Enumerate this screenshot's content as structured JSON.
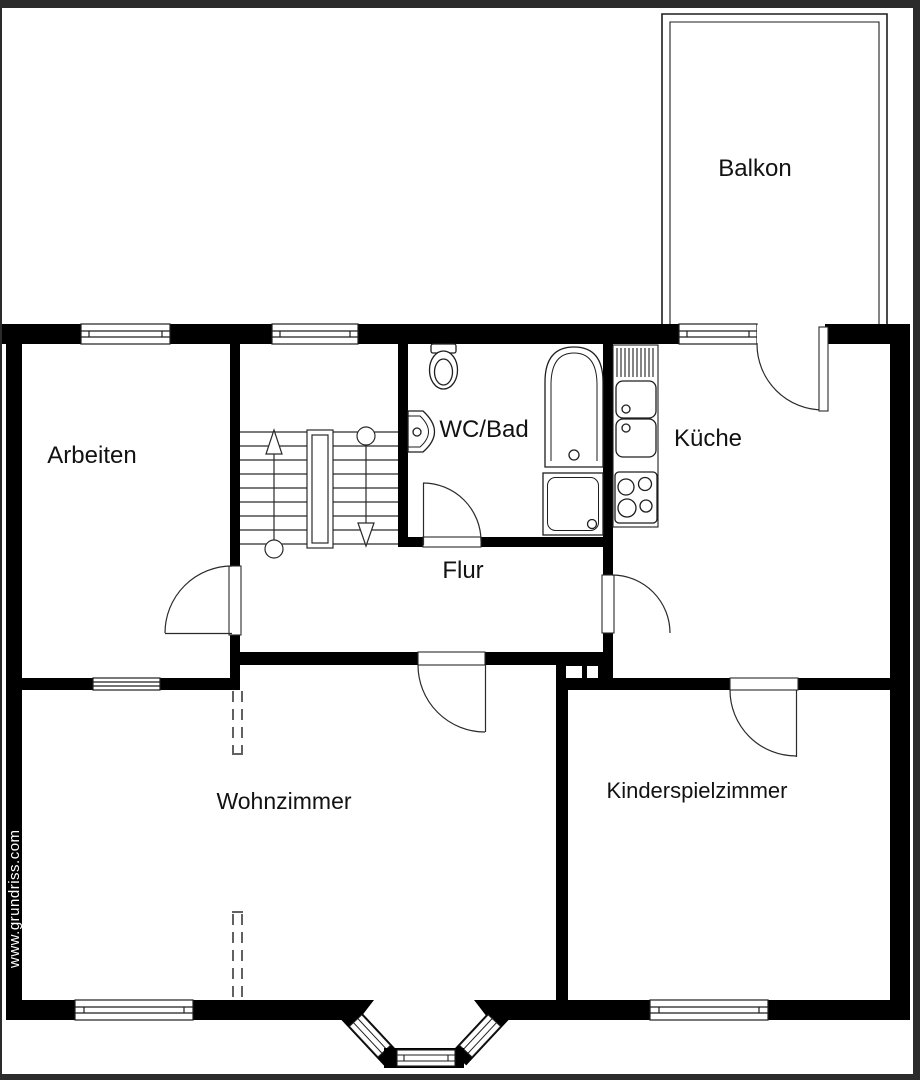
{
  "plan": {
    "title": "Grundriss Etagenwohnung",
    "watermark": "www.grundriss.com",
    "rooms": [
      {
        "id": "balkon",
        "label": "Balkon"
      },
      {
        "id": "arbeiten",
        "label": "Arbeiten"
      },
      {
        "id": "wc_bad",
        "label": "WC/Bad"
      },
      {
        "id": "kueche",
        "label": "Küche"
      },
      {
        "id": "flur",
        "label": "Flur"
      },
      {
        "id": "wohnzimmer",
        "label": "Wohnzimmer"
      },
      {
        "id": "kinderspielzimmer",
        "label": "Kinderspielzimmer"
      }
    ],
    "colors": {
      "wall": "#000000",
      "background": "#ffffff",
      "frame": "#2b2b2b",
      "line": "#1e1e1e",
      "watermark_text": "#ffffff"
    }
  }
}
